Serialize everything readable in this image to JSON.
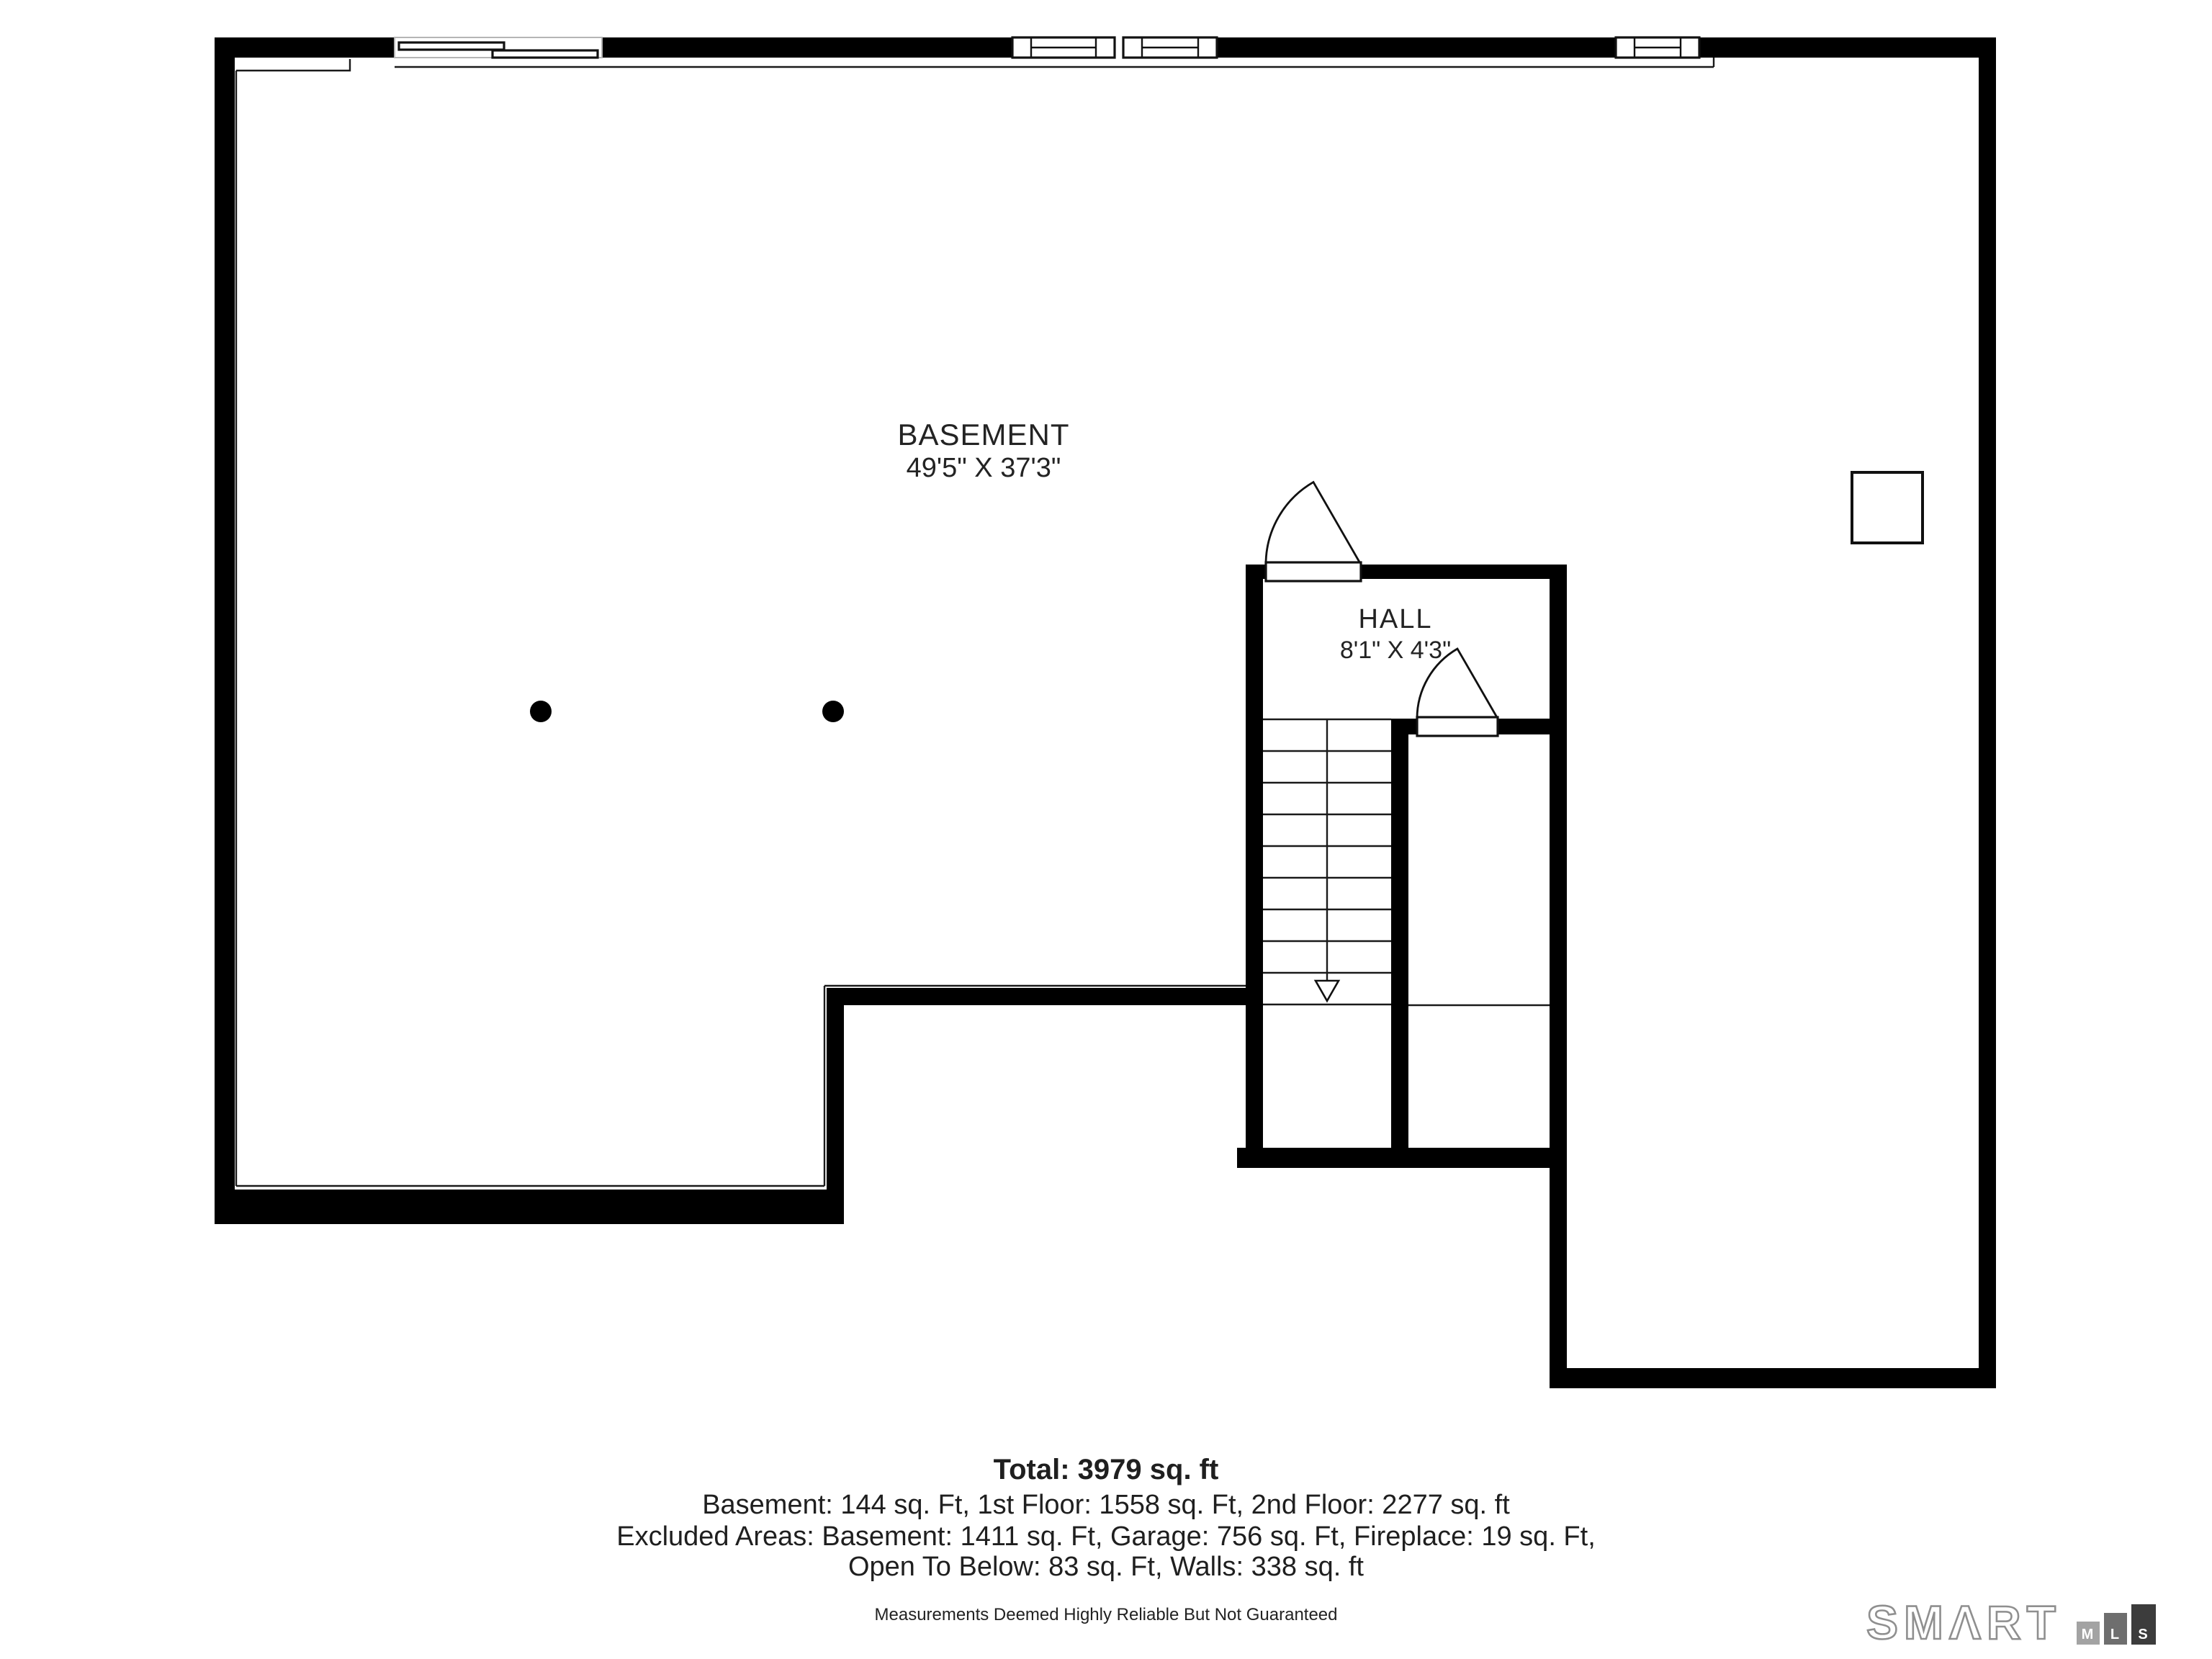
{
  "floorplan": {
    "rooms": [
      {
        "label": "BASEMENT",
        "dimensions": "49'5\" X 37'3\""
      },
      {
        "label": "HALL",
        "dimensions": "8'1\" X 4'3\""
      }
    ],
    "features": {
      "stairs": "stairs-with-down-arrow",
      "doors": "two-swing-door-arcs",
      "columns": "two-support-column-dots",
      "utility": "utility-box-square",
      "windows": "five-window-symbols-top-wall"
    }
  },
  "summary": {
    "total_label": "Total: 3979 sq. ft",
    "floors_line": "Basement: 144 sq. Ft, 1st Floor: 1558 sq. Ft, 2nd Floor: 2277 sq. ft",
    "excluded_line1": "Excluded Areas: Basement: 1411 sq. Ft, Garage: 756 sq. Ft, Fireplace: 19 sq. Ft,",
    "excluded_line2": "Open To Below: 83 sq. Ft, Walls: 338 sq. ft",
    "disclaimer": "Measurements Deemed Highly Reliable But Not Guaranteed"
  },
  "logo": {
    "brand_text": "SMΛRT",
    "blocks": [
      {
        "letter": "M",
        "color": "#a3a3a3"
      },
      {
        "letter": "L",
        "color": "#6e6e6e"
      },
      {
        "letter": "S",
        "color": "#3c3c3c"
      }
    ],
    "outline_color": "#8f8f8f"
  },
  "colors": {
    "wall": "#000000",
    "thin_line": "#1a1a1a",
    "text": "#1f1f1f"
  }
}
